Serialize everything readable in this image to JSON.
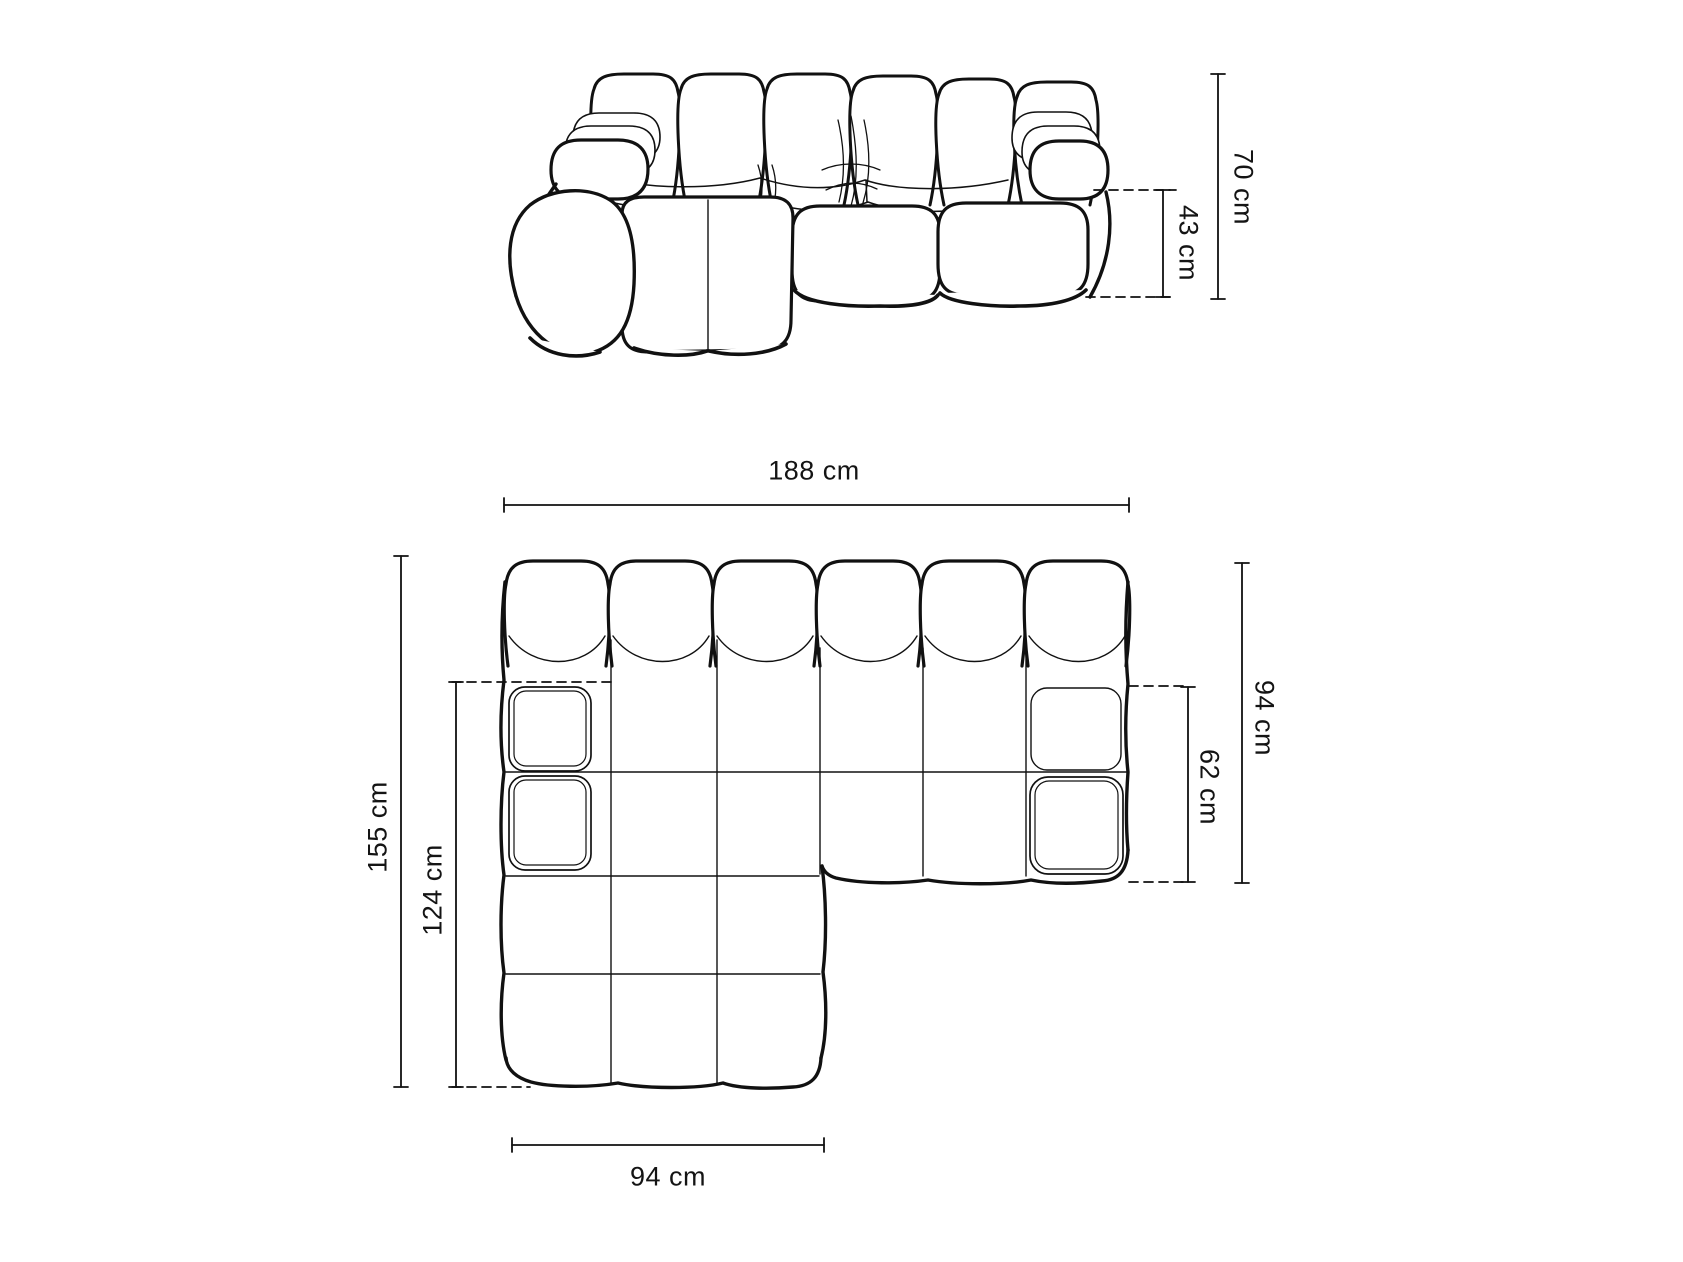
{
  "colors": {
    "background": "#ffffff",
    "line": "#111111",
    "text": "#141414"
  },
  "dims": {
    "height_total": "70 cm",
    "seat_height": "43 cm",
    "width_total": "188 cm",
    "depth_right": "94 cm",
    "seat_depth": "62 cm",
    "depth_total": "155 cm",
    "chaise_length": "124 cm",
    "chaise_width": "94 cm"
  }
}
